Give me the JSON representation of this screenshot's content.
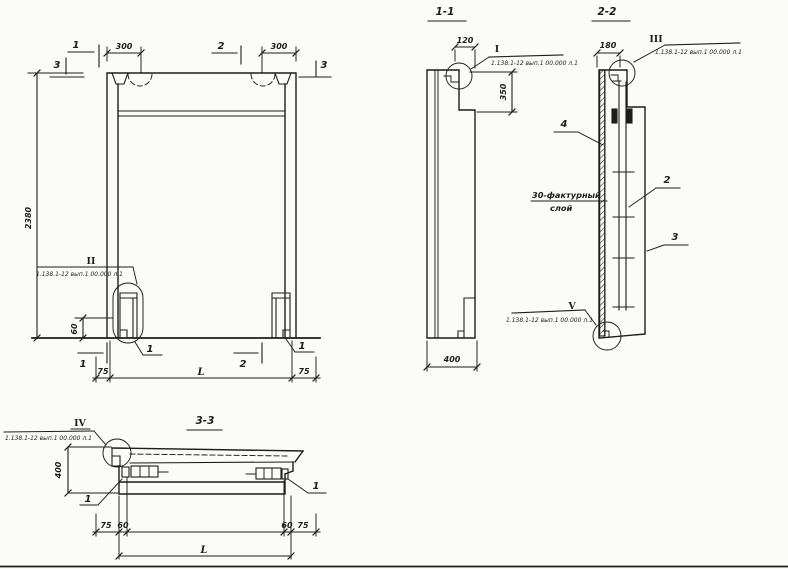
{
  "meta": {
    "ink": "#1d1d1b",
    "paper": "#fbfbf9"
  },
  "front": {
    "mark_1_top": "1",
    "mark_2_top": "2",
    "mark_3_left": "3",
    "mark_3_right": "3",
    "dim_300_left": "300",
    "dim_300_right": "300",
    "dim_height": "2380",
    "dim_60": "60",
    "detail_ii": "II",
    "detail_ii_ref": "1.138.1-12 вып.1 00.000 л.1",
    "callout_1_left": "1",
    "callout_1_right": "1",
    "mark_1_bottom": "1",
    "mark_2_bottom": "2",
    "dim_75_left": "75",
    "dim_span": "L",
    "dim_75_right": "75"
  },
  "section11": {
    "title": "1-1",
    "dim_120": "120",
    "dim_350": "350",
    "dim_400": "400",
    "detail_i": "I",
    "detail_i_ref": "1.138.1-12 вып.1 00.000 л.1"
  },
  "section22": {
    "title": "2-2",
    "dim_180": "180",
    "detail_iii": "III",
    "detail_iii_ref": "1.138.1-12 вып.1 00.000 л.1",
    "callout_4": "4",
    "callout_2": "2",
    "callout_3": "3",
    "note_line1": "30-фактурный",
    "note_line2": "слой",
    "detail_v": "V",
    "detail_v_ref": "1.138.1-12 вып.1 00.000 л.1"
  },
  "section33": {
    "title": "3-3",
    "detail_iv": "IV",
    "detail_iv_ref": "1.138.1-12 вып.1 00.000 л.1",
    "dim_400": "400",
    "callout_1_left": "1",
    "callout_1_right": "1",
    "dim_75_left": "75",
    "dim_60_left": "60",
    "dim_60_right": "60",
    "dim_75_right": "75",
    "dim_span": "L"
  }
}
